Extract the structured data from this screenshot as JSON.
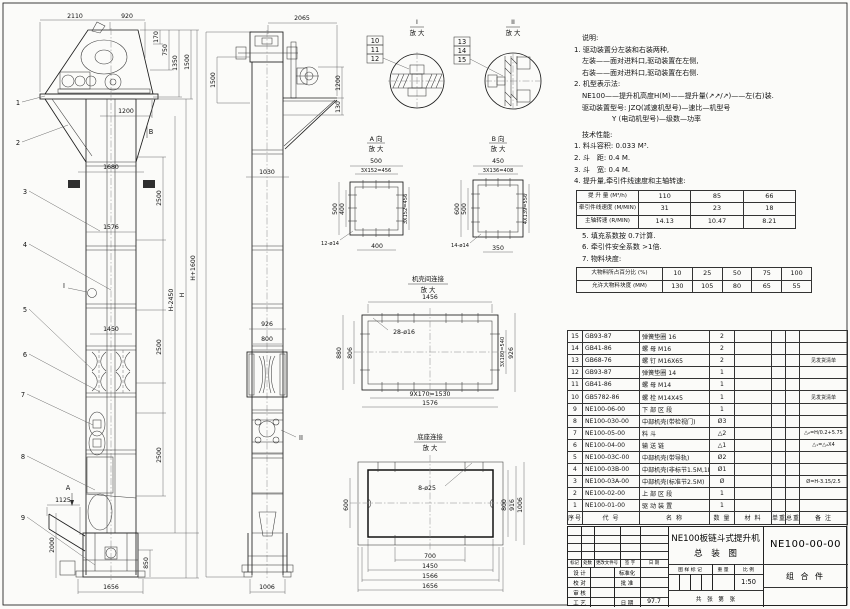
{
  "notes": {
    "heading": "说明:",
    "lines": [
      "1. 驱动装置分左装和右装两种,",
      "左装——面对进料口,驱动装置在左侧,",
      "右装——面对进料口,驱动装置在右侧.",
      "2. 机型表示法:",
      "NE100——提升机高度H(M)——提升量(↗↗/↗)——左(右)装.",
      "驱动装置型号: JZQ(减速机型号)—速比—机型号",
      "Y (电动机型号)—级数—功率"
    ],
    "tech_heading": "技术性能:",
    "tech_lines_a": [
      "1. 料斗容积: 0.033 M³.",
      "2. 斗　距: 0.4 M.",
      "3. 斗　宽: 0.4 M.",
      "4. 提升量,牵引件线速度和主轴转速:"
    ],
    "tech_lines_b": [
      "5. 填充系数按 0.7计算.",
      "6. 牵引件安全系数 >1倍.",
      "7. 物料块度:"
    ]
  },
  "chart_data": [
    {
      "type": "table",
      "title": "提升量,牵引件线速度和主轴转速",
      "rows": [
        {
          "label": "提 升 量 (M³/h)",
          "values": [
            "110",
            "85",
            "66"
          ]
        },
        {
          "label": "牵引件线速度 (M/MIN)",
          "values": [
            "31",
            "23",
            "18"
          ]
        },
        {
          "label": "主轴转速 (R/MIN)",
          "values": [
            "14.13",
            "10.47",
            "8.21"
          ]
        }
      ]
    },
    {
      "type": "table",
      "title": "物料块度",
      "rows": [
        {
          "label": "大物料所占百分比 (%)",
          "values": [
            "10",
            "25",
            "50",
            "75",
            "100"
          ]
        },
        {
          "label": "允许大物料块度 (MM)",
          "values": [
            "130",
            "105",
            "80",
            "65",
            "55"
          ]
        }
      ]
    }
  ],
  "bom": {
    "headers": [
      "序号",
      "代  号",
      "名      称",
      "数 量",
      "材    料",
      "单重",
      "总重",
      "备  注"
    ],
    "rows": [
      {
        "no": "15",
        "code": "GB93-87",
        "name": "弹簧垫圈 16",
        "qty": "2",
        "mat": "",
        "uw": "",
        "tw": "",
        "note": ""
      },
      {
        "no": "14",
        "code": "GB41-86",
        "name": "螺 母 M16",
        "qty": "2",
        "mat": "",
        "uw": "",
        "tw": "",
        "note": ""
      },
      {
        "no": "13",
        "code": "GB68-76",
        "name": "螺 钉 M16X65",
        "qty": "2",
        "mat": "",
        "uw": "",
        "tw": "",
        "note": "见发货清单"
      },
      {
        "no": "12",
        "code": "GB93-87",
        "name": "弹簧垫圈 14",
        "qty": "1",
        "mat": "",
        "uw": "",
        "tw": "",
        "note": ""
      },
      {
        "no": "11",
        "code": "GB41-86",
        "name": "螺 母 M14",
        "qty": "1",
        "mat": "",
        "uw": "",
        "tw": "",
        "note": ""
      },
      {
        "no": "10",
        "code": "GB5782-86",
        "name": "螺 栓 M14X45",
        "qty": "1",
        "mat": "",
        "uw": "",
        "tw": "",
        "note": "见发货清单"
      },
      {
        "no": "9",
        "code": "NE100-06-00",
        "name": "下 部 区 段",
        "qty": "1",
        "mat": "",
        "uw": "",
        "tw": "",
        "note": ""
      },
      {
        "no": "8",
        "code": "NE100-030-00",
        "name": "中部机壳(带检视门)",
        "qty": "Ø3",
        "mat": "",
        "uw": "",
        "tw": "",
        "note": ""
      },
      {
        "no": "7",
        "code": "NE100-05-00",
        "name": "料  斗",
        "qty": "△2",
        "mat": "",
        "uw": "",
        "tw": "",
        "note": "△₂=H/0.2+5.75"
      },
      {
        "no": "6",
        "code": "NE100-04-00",
        "name": "输 送 链",
        "qty": "△1",
        "mat": "",
        "uw": "",
        "tw": "",
        "note": "△₁=△₂X4"
      },
      {
        "no": "5",
        "code": "NE100-03C-00",
        "name": "中部机壳(带导轨)",
        "qty": "Ø2",
        "mat": "",
        "uw": "",
        "tw": "",
        "note": ""
      },
      {
        "no": "4",
        "code": "NE100-03B-00",
        "name": "中部机壳(非标节1.5M,1M)",
        "qty": "Ø1",
        "mat": "",
        "uw": "",
        "tw": "",
        "note": ""
      },
      {
        "no": "3",
        "code": "NE100-03A-00",
        "name": "中部机壳(标准节2.5M)",
        "qty": "Ø",
        "mat": "",
        "uw": "",
        "tw": "",
        "note": "Ø=H-3.15/2.5"
      },
      {
        "no": "2",
        "code": "NE100-02-00",
        "name": "上 部 区 段",
        "qty": "1",
        "mat": "",
        "uw": "",
        "tw": "",
        "note": ""
      },
      {
        "no": "1",
        "code": "NE100-01-00",
        "name": "驱 动 装 置",
        "qty": "1",
        "mat": "",
        "uw": "",
        "tw": "",
        "note": ""
      }
    ]
  },
  "title_block": {
    "title_line1": "NE100板链斗式提升机",
    "title_line2": "总　装　图",
    "drawing_no": "NE100-00-00",
    "part_type": "组  合  件",
    "rev_headers": [
      "标记",
      "处数",
      "更改文件号",
      "签 字",
      "日 期"
    ],
    "role_design": "设 计",
    "role_check": "校 对",
    "role_review": "审 核",
    "role_process": "工 艺",
    "role_std": "标准化",
    "role_approve": "批 准",
    "role_date_label": "日 期",
    "date": "97.7",
    "mark_label": "图 样 标 记",
    "weight_label": "重 量",
    "scale_label": "比 例",
    "scale": "1:50",
    "sheet_label": "共　张　第　张"
  },
  "front_view": {
    "balloons": [
      "1",
      "2",
      "3",
      "4",
      "5",
      "6",
      "7",
      "8",
      "9"
    ],
    "label_a": "A",
    "label_b": "B",
    "label_i": "I",
    "dims": {
      "d2110": "2110",
      "d920": "920",
      "d170": "170",
      "d750": "750",
      "d1350": "1350",
      "d1500": "1500",
      "d1200": "1200",
      "d1680": "1680",
      "d1576": "1576",
      "d1450": "1450",
      "d2500a": "2500",
      "d2500b": "2500",
      "d2500c": "2500",
      "dHm": "H-2450",
      "dH": "H",
      "dHp": "H+1600",
      "d1125": "1125",
      "d2000": "2000",
      "d850": "850",
      "d1656": "1656"
    }
  },
  "side_view": {
    "balloons": [
      "10",
      "11",
      "12"
    ],
    "label_ii": "II",
    "dims": {
      "d2065": "2065",
      "d1500": "1500",
      "d1200": "1200",
      "d130": "130",
      "d1030": "1030",
      "d926": "926",
      "d800": "800",
      "d1006": "1006"
    }
  },
  "detail_i": {
    "title": "I",
    "magnify": "放 大",
    "balloons": [
      "10",
      "11",
      "12"
    ]
  },
  "detail_ii": {
    "title": "II",
    "magnify": "放 大",
    "balloons": [
      "13",
      "14",
      "15"
    ]
  },
  "detail_a": {
    "title": "A 向",
    "magnify": "放 大",
    "dims": {
      "top": "500",
      "top2": "3X152=456",
      "left": "500",
      "left2": "400",
      "right": "3X152=456",
      "bottom": "400",
      "holes": "12-ø14"
    }
  },
  "detail_b": {
    "title": "B 向",
    "magnify": "放 大",
    "dims": {
      "top": "450",
      "top2": "3X136=408",
      "left": "600",
      "left2": "500",
      "right": "4X139=556",
      "bottom": "350",
      "holes": "14-ø14"
    }
  },
  "detail_case": {
    "title": "机壳间连接",
    "magnify": "放 大",
    "dims": {
      "top": "1456",
      "holes": "28-ø16",
      "left": "880",
      "left2": "806",
      "right": "3X180=540",
      "right2": "926",
      "bottom": "9X170=1530",
      "bottom2": "1576"
    }
  },
  "detail_base": {
    "title": "底座连接",
    "magnify": "放 大",
    "dims": {
      "holes": "8-ø25",
      "left": "600",
      "right": "800",
      "right2": "916",
      "right3": "1006",
      "b1": "700",
      "b2": "1450",
      "b3": "1566",
      "b4": "1656"
    }
  }
}
